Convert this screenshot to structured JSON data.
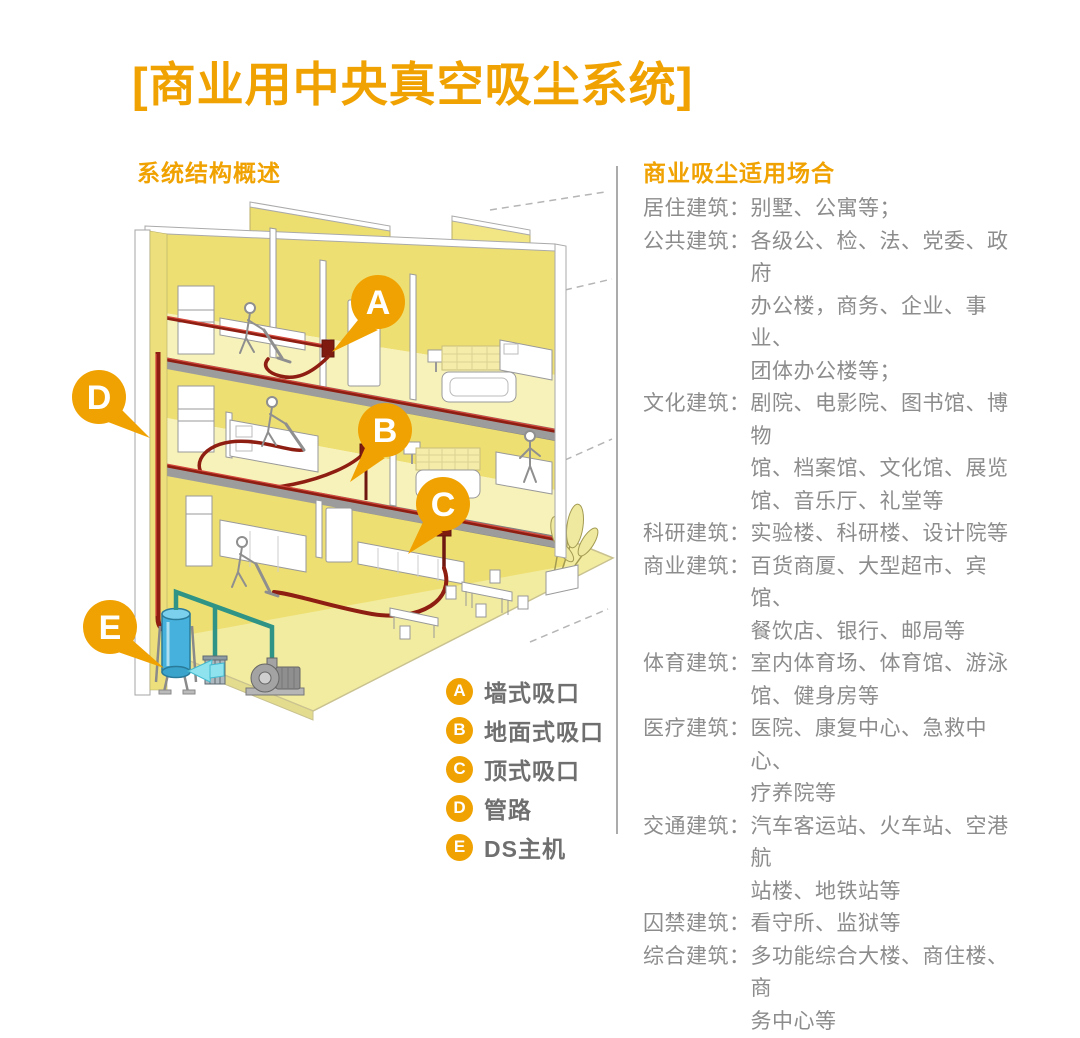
{
  "title": "[商业用中央真空吸尘系统]",
  "left": {
    "heading": "系统结构概述",
    "legend": [
      {
        "key": "A",
        "label": "墙式吸口"
      },
      {
        "key": "B",
        "label": "地面式吸口"
      },
      {
        "key": "C",
        "label": "顶式吸口"
      },
      {
        "key": "D",
        "label": "管路"
      },
      {
        "key": "E",
        "label": "DS主机"
      }
    ]
  },
  "right": {
    "heading": "商业吸尘适用场合",
    "items": [
      {
        "label": "居住建筑：",
        "content": "别墅、公寓等；"
      },
      {
        "label": "公共建筑：",
        "content": "各级公、检、法、党委、政府\n办公楼，商务、企业、事业、\n团体办公楼等；"
      },
      {
        "label": "文化建筑：",
        "content": "剧院、电影院、图书馆、博物\n馆、档案馆、文化馆、展览\n馆、音乐厅、礼堂等"
      },
      {
        "label": "科研建筑：",
        "content": "实验楼、科研楼、设计院等"
      },
      {
        "label": "商业建筑：",
        "content": "百货商厦、大型超市、宾馆、\n餐饮店、银行、邮局等"
      },
      {
        "label": "体育建筑：",
        "content": "室内体育场、体育馆、游泳\n馆、健身房等"
      },
      {
        "label": "医疗建筑：",
        "content": "医院、康复中心、急救中心、\n疗养院等"
      },
      {
        "label": "交通建筑：",
        "content": "汽车客运站、火车站、空港航\n站楼、地铁站等"
      },
      {
        "label": "囚禁建筑：",
        "content": "看守所、监狱等"
      },
      {
        "label": "综合建筑：",
        "content": "多功能综合大楼、商住楼、商\n务中心等"
      }
    ]
  },
  "diagram": {
    "markers": [
      {
        "letter": "A"
      },
      {
        "letter": "B"
      },
      {
        "letter": "C"
      },
      {
        "letter": "D"
      },
      {
        "letter": "E"
      }
    ]
  },
  "colors": {
    "accent_orange": "#F0A202",
    "pipe_red": "#8E1D12",
    "tank_blue": "#45B1DC",
    "exhaust_teal": "#2F9385",
    "wall_yellow": "#EEDF73",
    "floor_yellow": "#F7F2BA",
    "slab_gray": "#9C9C9C",
    "body_text_gray": "#8C8C8C",
    "legend_text_gray": "#6F6F6F"
  }
}
